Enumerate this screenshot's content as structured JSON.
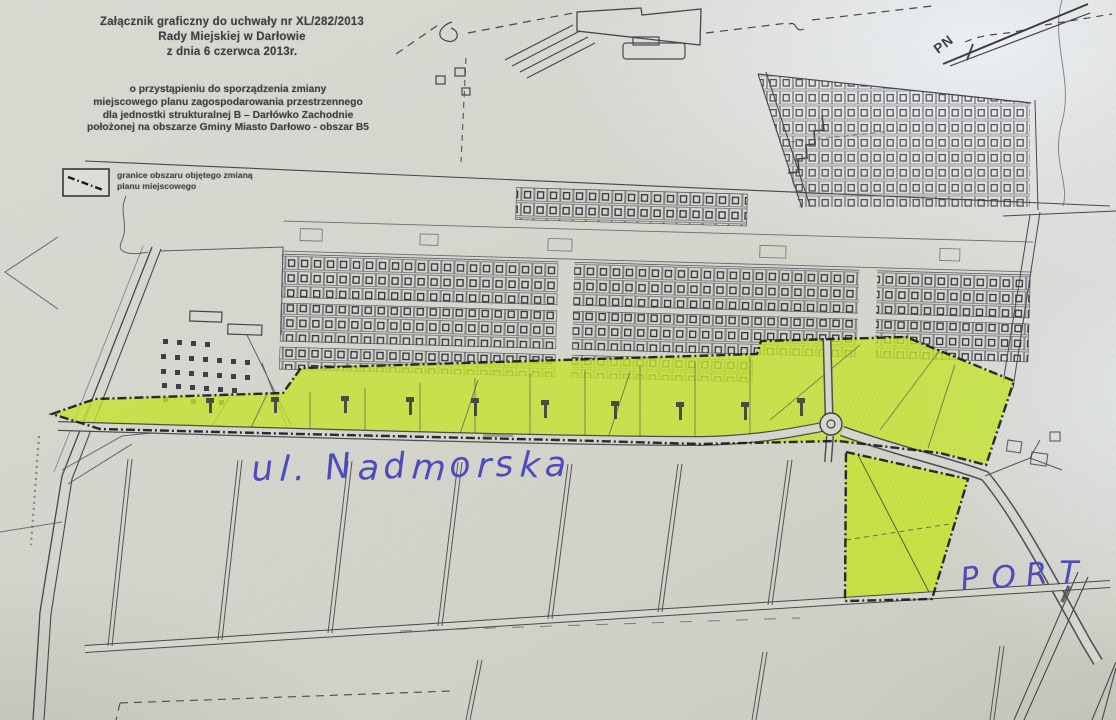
{
  "header": {
    "line1": "Załącznik graficzny do uchwały nr XL/282/2013",
    "line2": "Rady Miejskiej w Darłowie",
    "line3": "z dnia 6 czerwca 2013r."
  },
  "subject": {
    "line1": "o przystąpieniu do sporządzenia zmiany",
    "line2": "miejscowego planu zagospodarowania przestrzennego",
    "line3": "dla jednostki strukturalnej B – Darłówko Zachodnie",
    "line4": "położonej na obszarze Gminy Miasto Darłowo - obszar B5"
  },
  "legend": {
    "item": {
      "symbol": "dash-dot-boundary-line",
      "label_line1": "granice obszaru objętego zmianą",
      "label_line2": "planu miejscowego"
    }
  },
  "compass": {
    "north_label": "PN"
  },
  "handwritten": {
    "street_label": "ul. Nadmorska",
    "port_label": "PORT",
    "ink_color": "#4d4bbd"
  },
  "map": {
    "highlight_color": "#c4e52d",
    "line_color": "#45454d",
    "paper_color": "#d5d6cd"
  }
}
